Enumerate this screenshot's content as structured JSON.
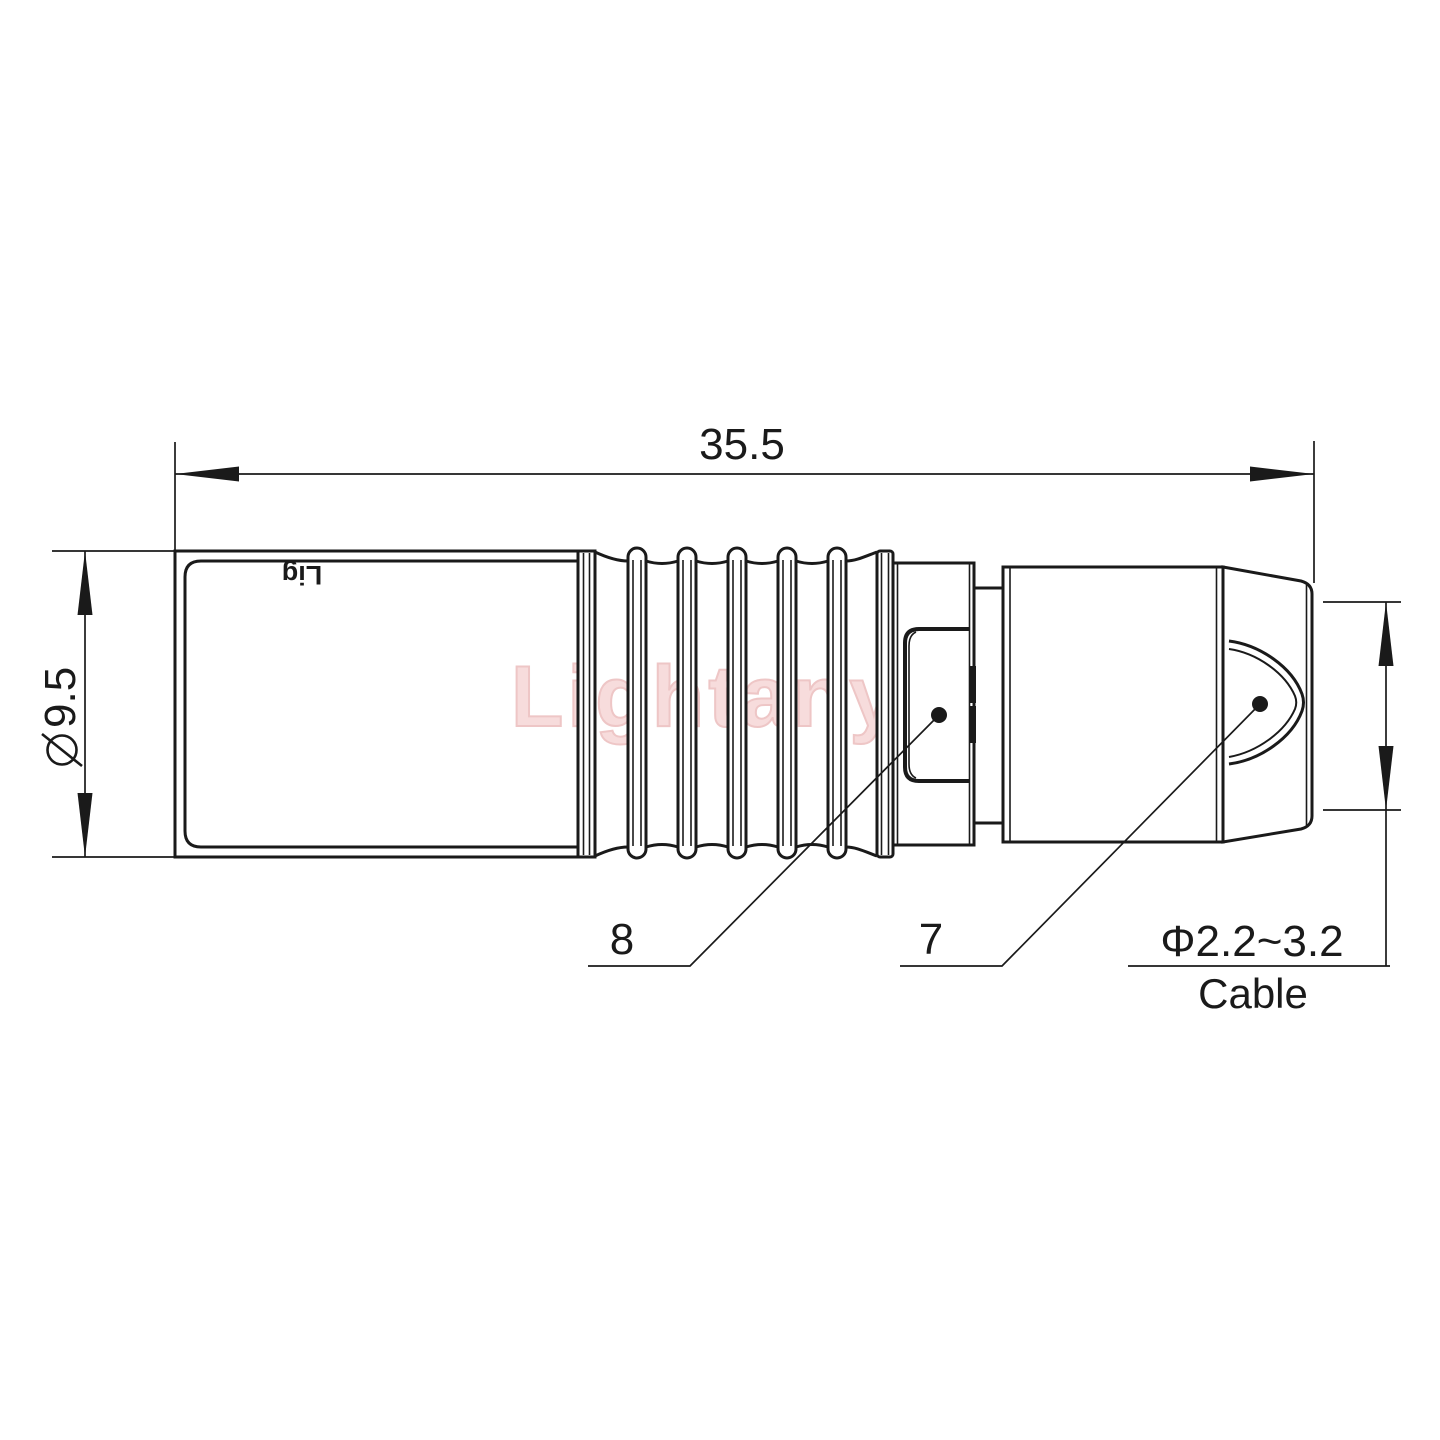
{
  "drawing": {
    "watermark": "Lightany",
    "body_engraving": "Lig",
    "dimensions": {
      "overall_length": "35.5",
      "diameter_symbol": "⌀",
      "diameter_value": "9.5",
      "cable_range": "Φ2.2~3.2",
      "cable_label": "Cable"
    },
    "part_labels": {
      "latch_sleeve": "8",
      "rear_nut": "7"
    },
    "colors": {
      "line": "#1a1a1a",
      "watermark_fill": "#f7dcdc",
      "watermark_outline": "#eec6c6",
      "background": "#ffffff"
    }
  }
}
